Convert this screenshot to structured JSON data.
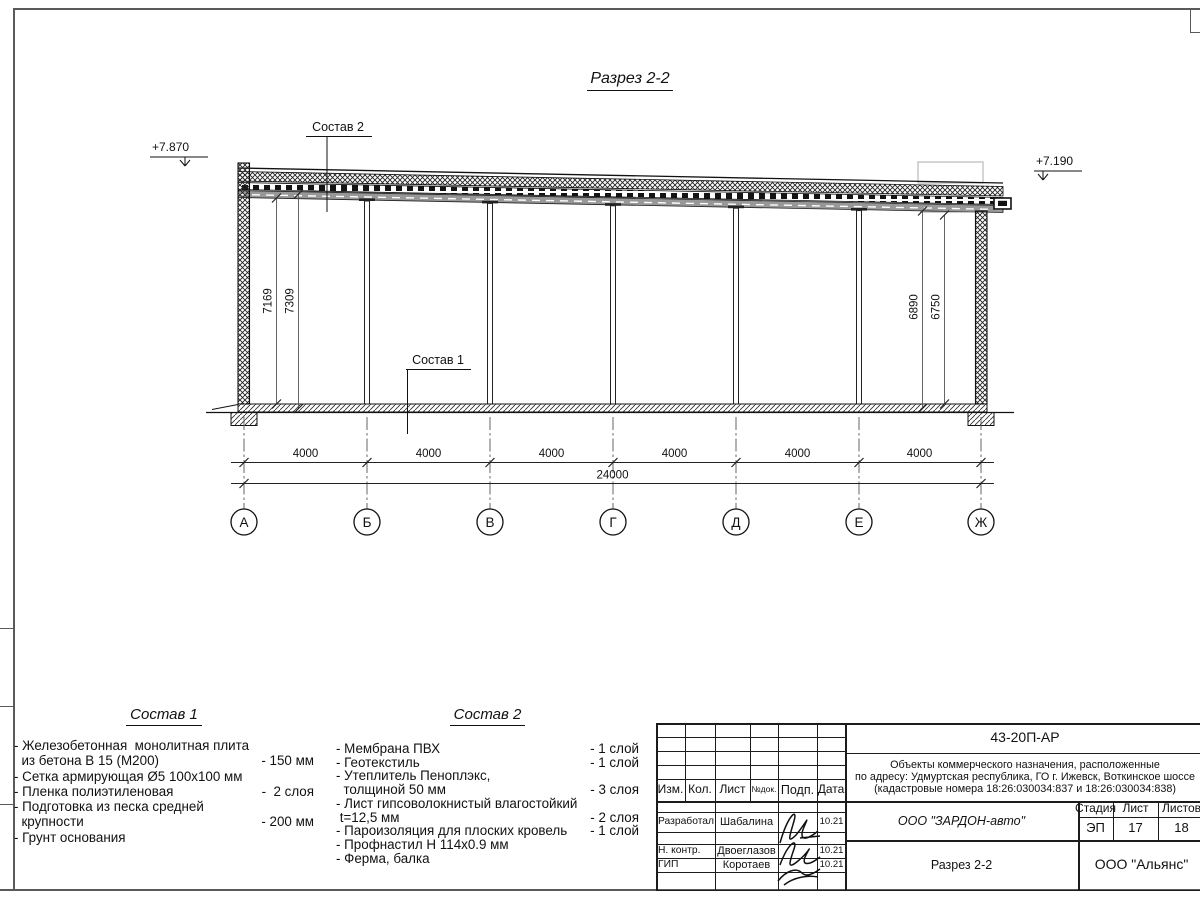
{
  "page": {
    "title": "Разрез 2-2",
    "elevation_left": "+7.870",
    "elevation_right": "+7.190"
  },
  "colors": {
    "line": "#1a1a1a",
    "frame": "#5a5a5a",
    "roof_gray": "#989898"
  },
  "drawing": {
    "callout_top": "Состав 2",
    "callout_floor": "Состав 1",
    "height_dims": {
      "left_inner": "7169",
      "left_outer": "7309",
      "right_inner": "6890",
      "right_outer": "6750"
    },
    "bay_dims": [
      "4000",
      "4000",
      "4000",
      "4000",
      "4000",
      "4000"
    ],
    "total_dim": "24000",
    "axes": [
      "А",
      "Б",
      "В",
      "Г",
      "Д",
      "Е",
      "Ж"
    ]
  },
  "composition1": {
    "title": "Состав 1",
    "items": [
      {
        "text": "- Железобетонная  монолитная плита",
        "value": ""
      },
      {
        "text": "  из бетона В 15 (М200)",
        "value": "- 150 мм"
      },
      {
        "text": "- Сетка армирующая Ø5 100х100 мм",
        "value": ""
      },
      {
        "text": "- Пленка полиэтиленовая",
        "value": "-  2 слоя"
      },
      {
        "text": "- Подготовка из песка средней",
        "value": ""
      },
      {
        "text": "  крупности",
        "value": "- 200 мм"
      },
      {
        "text": "- Грунт основания",
        "value": ""
      }
    ]
  },
  "composition2": {
    "title": "Состав 2",
    "items": [
      {
        "text": "- Мембрана ПВХ",
        "value": "- 1 слой"
      },
      {
        "text": "- Геотекстиль",
        "value": "- 1 слой"
      },
      {
        "text": "- Утеплитель Пеноплэкс,",
        "value": ""
      },
      {
        "text": "  толщиной 50 мм",
        "value": "- 3 слоя"
      },
      {
        "text": "- Лист гипсоволокнистый влагостойкий",
        "value": ""
      },
      {
        "text": " t=12,5 мм",
        "value": "- 2 слоя"
      },
      {
        "text": "- Пароизоляция для плоских кровель",
        "value": "- 1 слой"
      },
      {
        "text": "- Профнастил Н 114х0.9 мм",
        "value": ""
      },
      {
        "text": "- Ферма, балка",
        "value": ""
      }
    ]
  },
  "stamp": {
    "doc_number": "43-20П-АР",
    "address_line1": "Объекты коммерческого назначения, расположенные",
    "address_line2": "по адресу: Удмуртская республика, ГО г. Ижевск, Воткинское шоссе",
    "address_line3": "(кадастровые номера 18:26:030034:837 и 18:26:030034:838)",
    "col_izm": "Изм.",
    "col_kol": "Кол.",
    "col_list": "Лист",
    "col_doc": "№док.",
    "col_sign": "Подп.",
    "col_date": "Дата",
    "rows": [
      {
        "role": "Разработал",
        "name": "Шабалина",
        "date": "10.21"
      },
      {
        "role": "Н. контр.",
        "name": "Двоеглазов",
        "date": "10.21"
      },
      {
        "role": "ГИП",
        "name": "Коротаев",
        "date": "10.21"
      }
    ],
    "company": "ООО \"ЗАРДОН-авто\"",
    "sheet_title": "Разрез 2-2",
    "contractor": "ООО \"Альянс\"",
    "stage_label": "Стадия",
    "list_label": "Лист",
    "listov_label": "Листов",
    "stage_value": "ЭП",
    "list_value": "17",
    "listov_value": "18"
  }
}
